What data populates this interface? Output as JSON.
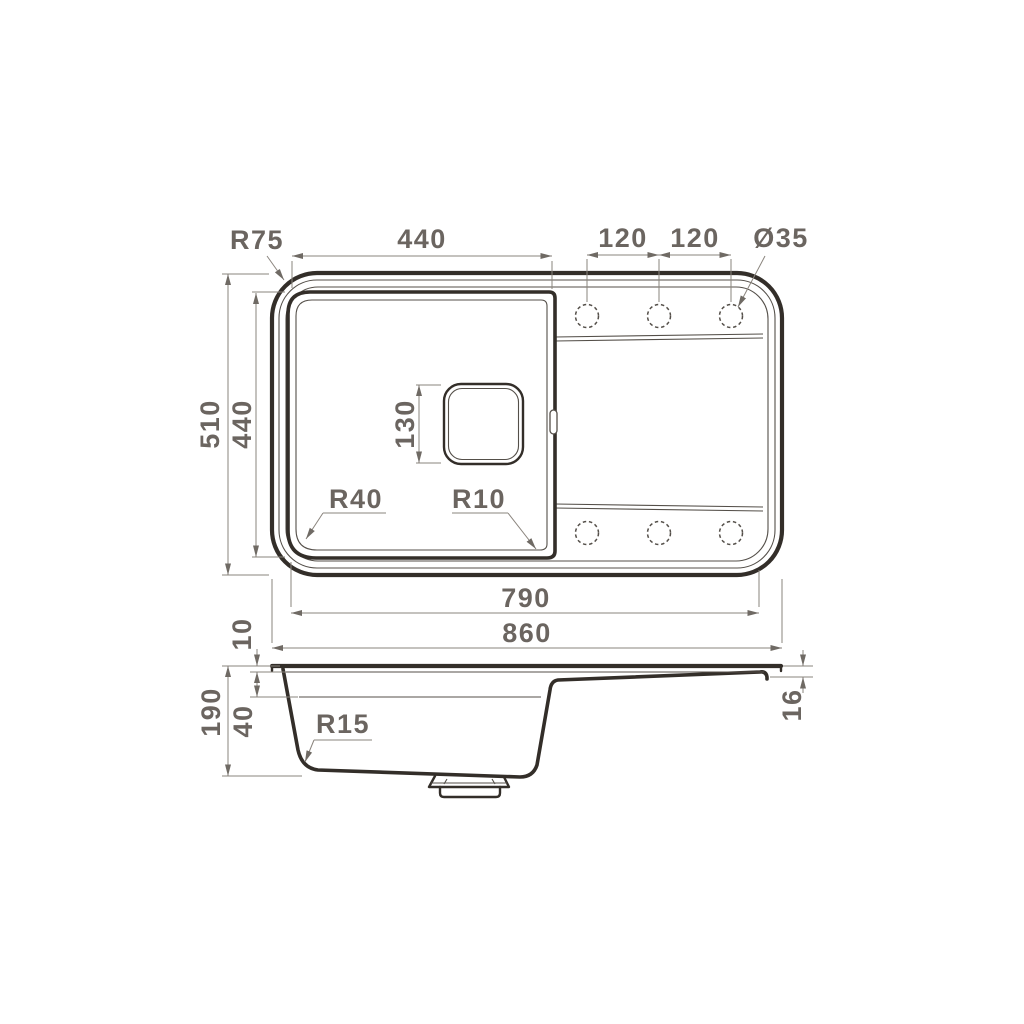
{
  "drawing": {
    "subject": "kitchen-sink-technical-drawing",
    "colors": {
      "background": "#ffffff",
      "line": "#332e29",
      "dimension": "#8a847d",
      "text": "#6b6560"
    }
  },
  "top_view": {
    "rim_corner_radius": "R75",
    "bowl_width": "440",
    "hole_pitch_left": "120",
    "hole_pitch_right": "120",
    "hole_diameter": "Ø35",
    "overall_depth": "510",
    "bowl_depth": "440",
    "drain_size": "130",
    "bowl_corner_radius_left": "R40",
    "bowl_corner_radius_right": "R10",
    "inner_length": "790",
    "overall_length": "860"
  },
  "side_view": {
    "rim_height": "10",
    "ledge_depth": "40",
    "overall_height": "190",
    "bottom_corner_radius": "R15",
    "drainboard_drop": "16"
  }
}
